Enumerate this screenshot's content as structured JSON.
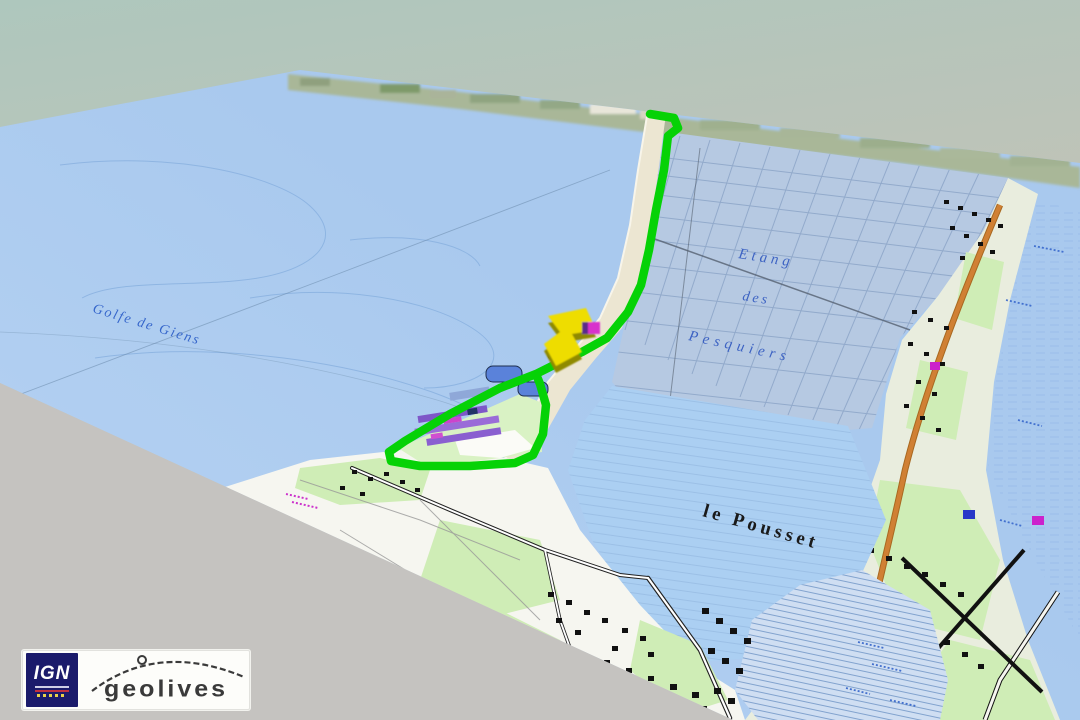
{
  "view": {
    "labels": {
      "gulf": "Golfe de Giens",
      "lagoon_line1": "Etang",
      "lagoon_line2": "des",
      "lagoon_line3": "Pesquiers",
      "locality": "le Pousset"
    },
    "marker": "position-arrow",
    "colors": {
      "sea": "#a9c9ee",
      "lagoon": "#abcff2",
      "salt_grid": "#b6c9e2",
      "land": "#f6f6f0",
      "vegetation": "#cfedb6",
      "track": "#06d206",
      "marker_yellow": "#eedd00",
      "marker_shadow": "#8f8a00",
      "road_orange": "#d08034",
      "foreground": "#c5c3c0",
      "label_blue": "#2a5cc8",
      "logo_navy": "#1b1b6b"
    }
  },
  "branding": {
    "ign": "IGN",
    "geolives": "geolives"
  }
}
